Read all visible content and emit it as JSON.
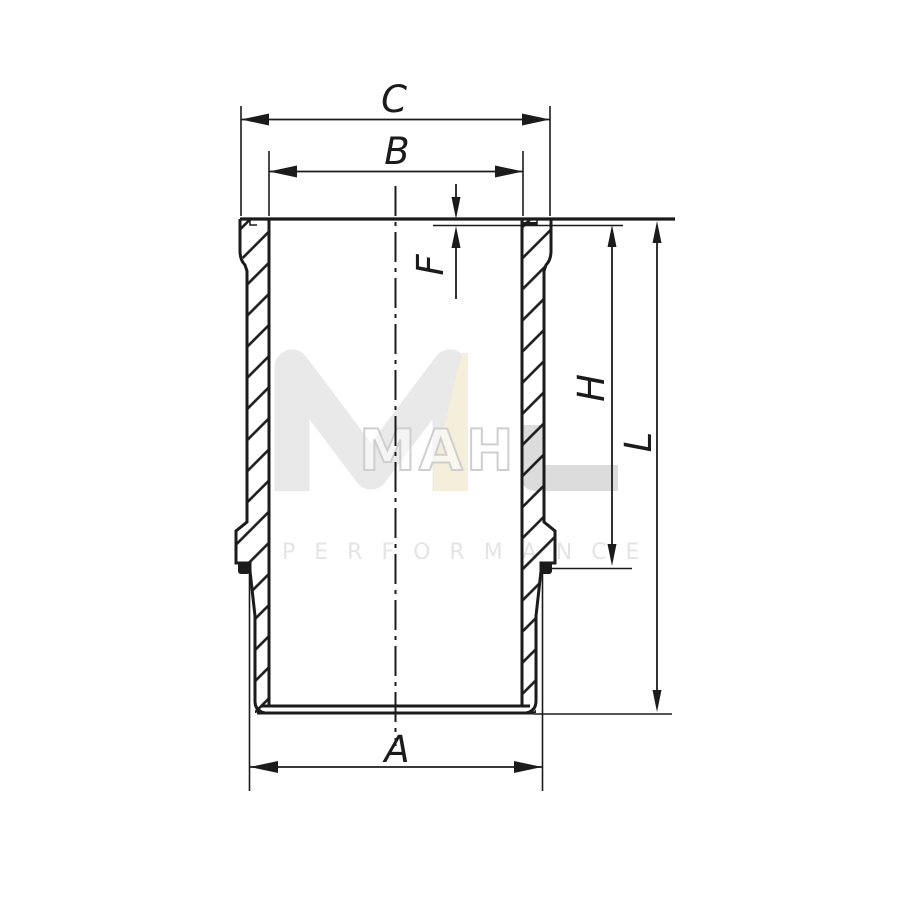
{
  "page": {
    "background": "#ffffff",
    "line_color": "#1b1b1b"
  },
  "drawing": {
    "dimension_labels": {
      "a": "A",
      "b": "B",
      "c": "C",
      "f": "F",
      "h": "H",
      "l": "L"
    }
  },
  "watermark": {
    "brand": "MAHLE",
    "outline_letters": "MAH",
    "tagline": "PERFORMANCE",
    "colors": {
      "monogram_gray": "#e9e9e9",
      "accent_beige": "#f4eeda",
      "outline_gray": "#cfcfcf",
      "solid_gray": "#dcdcdc",
      "tagline_gray": "#e4e4e4"
    }
  }
}
